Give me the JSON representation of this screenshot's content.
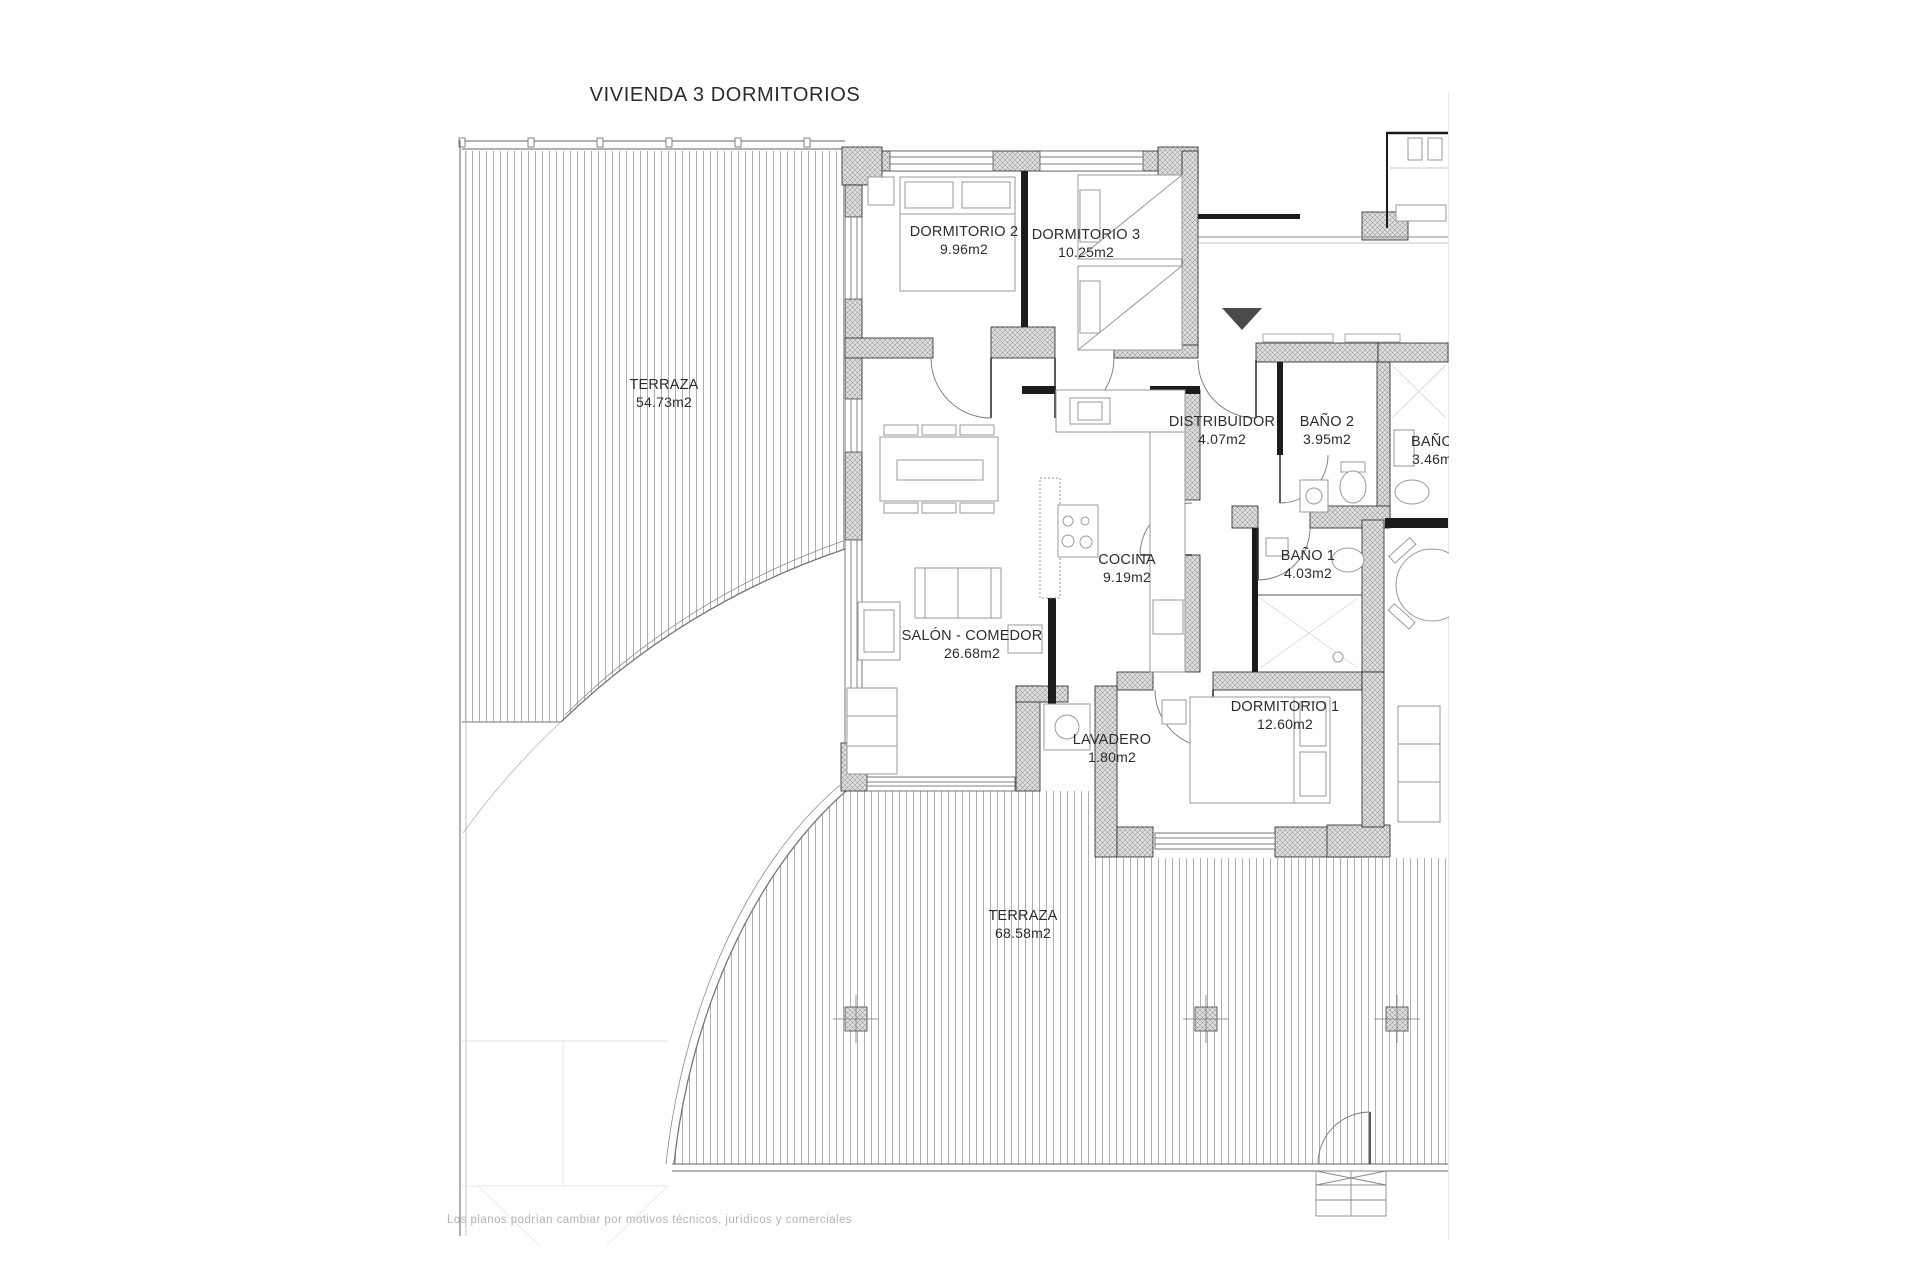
{
  "page": {
    "title": "VIVIENDA 3 DORMITORIOS",
    "disclaimer": "Los planos podrían cambiar por motivos técnicos, jurídicos y comerciales"
  },
  "plan": {
    "rooms": [
      {
        "id": "terraza-superior",
        "name": "TERRAZA",
        "area": "54.73m2"
      },
      {
        "id": "dormitorio-2",
        "name": "DORMITORIO 2",
        "area": "9.96m2"
      },
      {
        "id": "dormitorio-3",
        "name": "DORMITORIO 3",
        "area": "10.25m2"
      },
      {
        "id": "distribuidor",
        "name": "DISTRIBUIDOR",
        "area": "4.07m2"
      },
      {
        "id": "bano-2",
        "name": "BAÑO 2",
        "area": "3.95m2"
      },
      {
        "id": "bano-contiguo",
        "name": "BAÑO",
        "area": "3.46m"
      },
      {
        "id": "cocina",
        "name": "COCINA",
        "area": "9.19m2"
      },
      {
        "id": "bano-1",
        "name": "BAÑO 1",
        "area": "4.03m2"
      },
      {
        "id": "salon-comedor",
        "name": "SALÓN - COMEDOR",
        "area": "26.68m2"
      },
      {
        "id": "lavadero",
        "name": "LAVADERO",
        "area": "1.80m2"
      },
      {
        "id": "dormitorio-1",
        "name": "DORMITORIO 1",
        "area": "12.60m2"
      },
      {
        "id": "terraza-inferior",
        "name": "TERRAZA",
        "area": "68.58m2"
      }
    ],
    "markers": {
      "entrance_arrow": "entrada"
    },
    "colors": {
      "wall": "#1c1c1c",
      "wall_fill": "#dcdcdc",
      "deck_line": "#9b9b9b",
      "drawing_line": "#8a8a8a",
      "text": "#2d2d2d",
      "muted_text": "#b4b4b4"
    }
  }
}
